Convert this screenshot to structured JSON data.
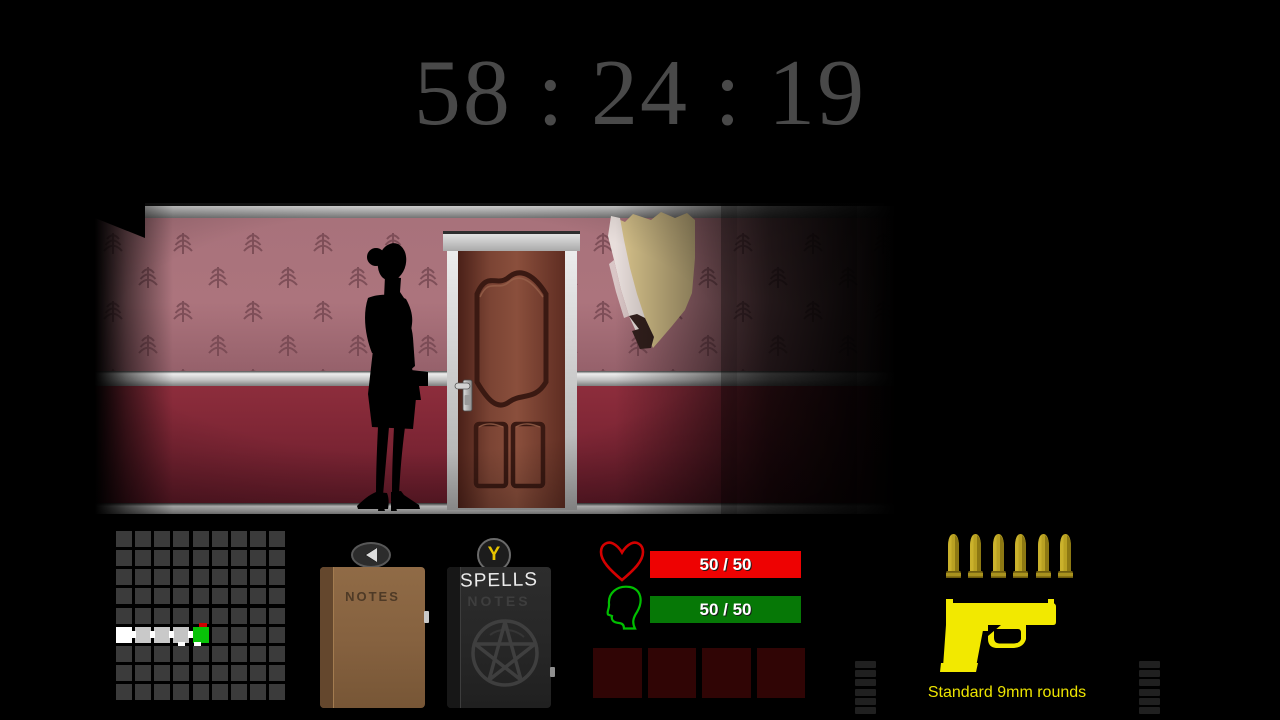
{
  "timer": {
    "display": "58 : 24 : 19"
  },
  "hud": {
    "minimap": {
      "rows": 9,
      "cols": 9,
      "cell_color": "#3b3b3b",
      "rooms": [
        {
          "row": 5,
          "col": 0,
          "color": "#ffffff"
        },
        {
          "row": 5,
          "col": 1,
          "color": "#c9c9c9"
        },
        {
          "row": 5,
          "col": 2,
          "color": "#c9c9c9"
        },
        {
          "row": 5,
          "col": 3,
          "color": "#c4c4c4"
        },
        {
          "row": 5,
          "col": 4,
          "color": "#08c208"
        }
      ],
      "doors": [
        {
          "row": 5,
          "after_col": 0
        },
        {
          "row": 5,
          "after_col": 1
        },
        {
          "row": 5,
          "after_col": 2
        },
        {
          "row": 5,
          "after_col": 3
        }
      ],
      "bottom_tabs": [
        {
          "row": 5,
          "col": 3,
          "align": "center"
        },
        {
          "row": 5,
          "col": 4,
          "align": "left"
        }
      ],
      "marker": {
        "row": 5,
        "col": 4,
        "side": "top",
        "color": "#cf0000"
      }
    },
    "notes_book": {
      "label": "NOTES"
    },
    "prev_button": {
      "icon": "left-arrow"
    },
    "spells_book": {
      "label": "SPELLS",
      "watermark": "NOTES"
    },
    "spells_key_button": {
      "key_label": "Y"
    },
    "health": {
      "value": "50 / 50",
      "bar_color": "#ee0202",
      "icon": "heart"
    },
    "sanity": {
      "value": "50 / 50",
      "bar_color": "#067806",
      "icon": "head-profile"
    },
    "item_slots": {
      "count": 4,
      "color": "#300505"
    },
    "ammo": {
      "bullet_count": 6,
      "caption": "Standard 9mm rounds",
      "weapon_icon": "pistol",
      "accent_color": "#f2e900"
    },
    "scroll_marks": {
      "per_side": 6
    }
  }
}
